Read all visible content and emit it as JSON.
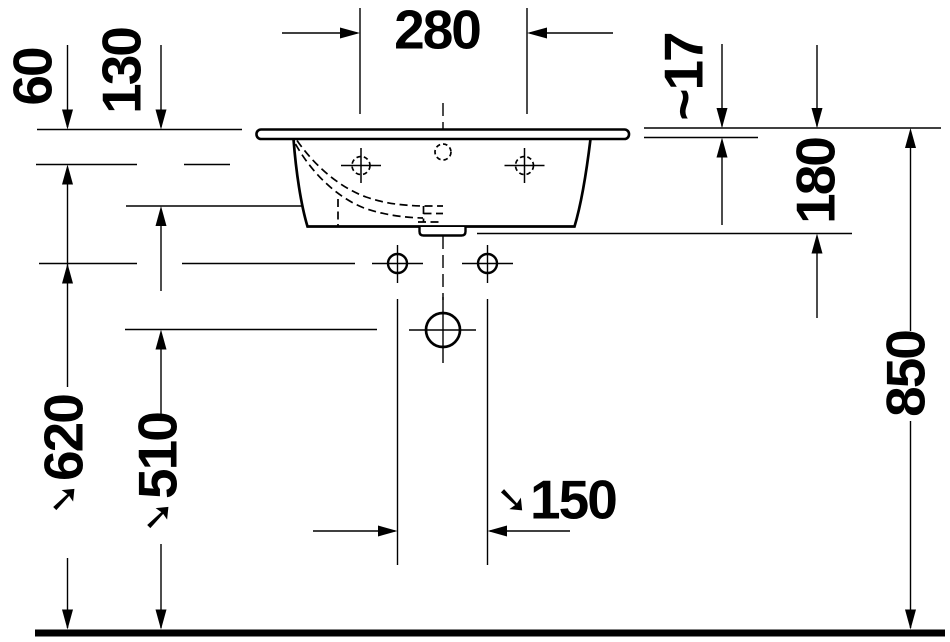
{
  "page": {
    "background": "#ffffff",
    "ink": "#000000"
  },
  "drawing": {
    "type": "technical-elevation",
    "units": "mm"
  },
  "labels": {
    "width_280": {
      "text": "280"
    },
    "offset_60": {
      "text": "60"
    },
    "offset_130": {
      "text": "130"
    },
    "thickness_17": {
      "text": "~17"
    },
    "depth_180": {
      "text": "180"
    },
    "height_850": {
      "text": "850"
    },
    "height_620": {
      "arrow": "➘",
      "text": "620"
    },
    "height_510": {
      "arrow": "➘",
      "text": "510"
    },
    "spacing_150": {
      "arrow": "➘",
      "text": "150"
    }
  }
}
